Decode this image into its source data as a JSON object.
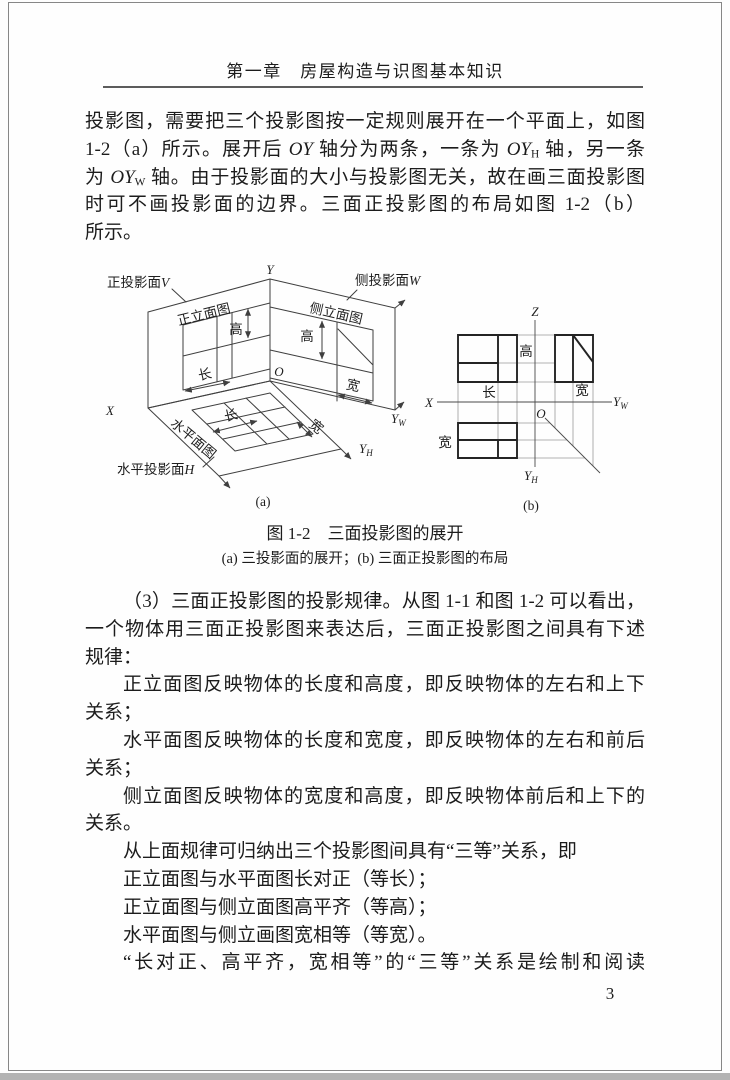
{
  "page": {
    "header": {
      "chapter_title": "第一章　房屋构造与识图基本知识"
    },
    "paragraph_1": {
      "lines": [
        "投影图，需要把三个投影图按一定规则展开在一个平面上，如图",
        "1-2（a）所示。展开后 *OY* 轴分为两条，一条为 *OY*_{H} 轴，另一条",
        "为 *OY*_{W} 轴。由于投影面的大小与投影图无关，故在画三面投影图",
        "时可不画投影面的边界。三面正投影图的布局如图 1-2（b）",
        "所示。"
      ]
    },
    "figure": {
      "caption": "图 1-2　三面投影图的展开",
      "subcaption": "(a) 三投影面的展开；(b) 三面正投影图的布局",
      "sub_a": {
        "tag": "(a)",
        "plane_front_label": "正投影面",
        "plane_front_letter": "V",
        "plane_side_label": "侧投影面",
        "plane_side_letter": "W",
        "plane_horizontal_label": "水平投影面",
        "plane_horizontal_letter": "H",
        "view_front": "正立面图",
        "view_side": "侧立面图",
        "view_plan": "水平面图",
        "dim_height_front": "高",
        "dim_height_side": "高",
        "dim_length_front": "长",
        "dim_length_plan": "长",
        "dim_width_side": "宽",
        "dim_width_plan": "宽",
        "axis_y": "Y",
        "axis_x": "X",
        "origin": "O",
        "axis_yw_main": "Y",
        "axis_yw_sub": "W",
        "axis_yh_main": "Y",
        "axis_yh_sub": "H"
      },
      "sub_b": {
        "tag": "(b)",
        "axis_z": "Z",
        "axis_x": "X",
        "origin": "O",
        "axis_yw_main": "Y",
        "axis_yw_sub": "W",
        "axis_yh_main": "Y",
        "axis_yh_sub": "H",
        "dim_height": "高",
        "dim_length": "长",
        "dim_width_side": "宽",
        "dim_width_plan": "宽"
      }
    },
    "paragraph_2": {
      "lines": [
        "（3）三面正投影图的投影规律。从图 1-1 和图 1-2 可以看出，",
        "一个物体用三面正投影图来表达后，三面正投影图之间具有下述",
        "规律：",
        "正立面图反映物体的长度和高度，即反映物体的左右和上下",
        "关系；",
        "水平面图反映物体的长度和宽度，即反映物体的左右和前后",
        "关系；",
        "侧立面图反映物体的宽度和高度，即反映物体前后和上下的",
        "关系。",
        "从上面规律可归纳出三个投影图间具有“三等”关系，即",
        "正立面图与水平面图长对正（等长）；",
        "正立面图与侧立面图高平齐（等高）；",
        "水平面图与侧立画图宽相等（等宽）。",
        "“长对正、高平齐，宽相等”的“三等”关系是绘制和阅读"
      ]
    },
    "page_number": "3"
  }
}
